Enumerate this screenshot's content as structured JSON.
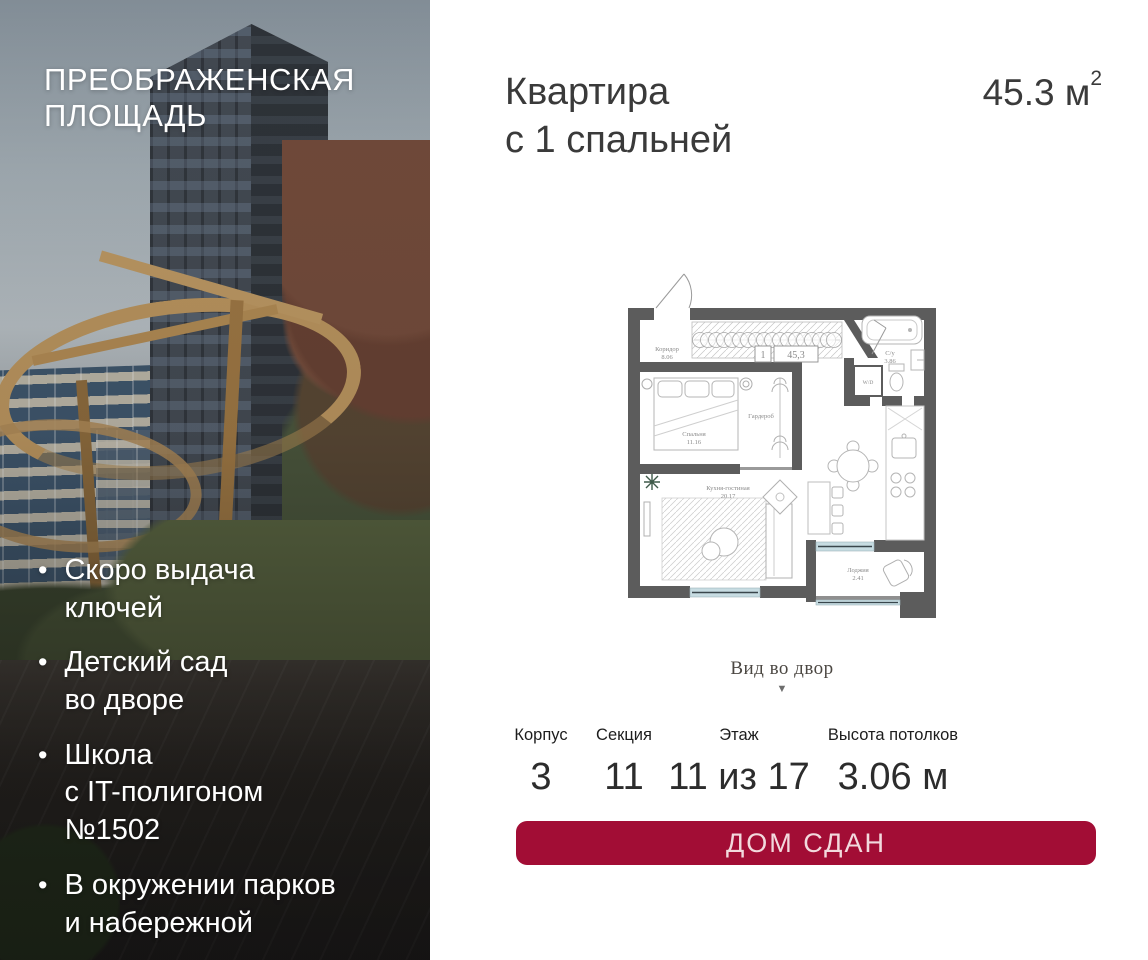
{
  "hero": {
    "bullet": "•",
    "title": [
      "ПРЕОБРАЖЕНСКАЯ",
      "ПЛОЩАДЬ"
    ],
    "features": [
      [
        "Скоро выдача",
        "ключей"
      ],
      [
        "Детский сад",
        "во дворе"
      ],
      [
        "Школа",
        "с IT-полигоном",
        "№1502"
      ],
      [
        "В окружении парков",
        "и набережной"
      ]
    ]
  },
  "listing": {
    "title": [
      "Квартира",
      "с 1 спальней"
    ],
    "area": {
      "value": "45.3",
      "unit": " м",
      "power": "2"
    }
  },
  "plan": {
    "corridor": {
      "name": "Коридор",
      "area": "8.06"
    },
    "unit": {
      "number": "1",
      "area": "45,3"
    },
    "bathroom": {
      "name": "С/у",
      "area": "3.86"
    },
    "wd": "W/D",
    "bedroom": {
      "name": "Спальня",
      "area": "11.16"
    },
    "wardrobe": "Гардероб",
    "kitchen": {
      "name": "Кухня-гостиная",
      "area": "20.17"
    },
    "loggia": {
      "name": "Лоджия",
      "area": "2.41"
    },
    "view": {
      "label": "Вид во двор",
      "arrow": "▼"
    }
  },
  "specs": [
    {
      "label": "Корпус",
      "value": "3"
    },
    {
      "label": "Секция",
      "value": "11"
    },
    {
      "label": "Этаж",
      "value": "11 из 17"
    },
    {
      "label": "Высота потолков",
      "value": "3.06 м"
    }
  ],
  "cta": {
    "label": "ДОМ СДАН"
  },
  "colors": {
    "accent": "#A20D35",
    "cta_text": "#F2D9DD",
    "wall": "#5C5C5C",
    "window": "#C7DCE2"
  }
}
